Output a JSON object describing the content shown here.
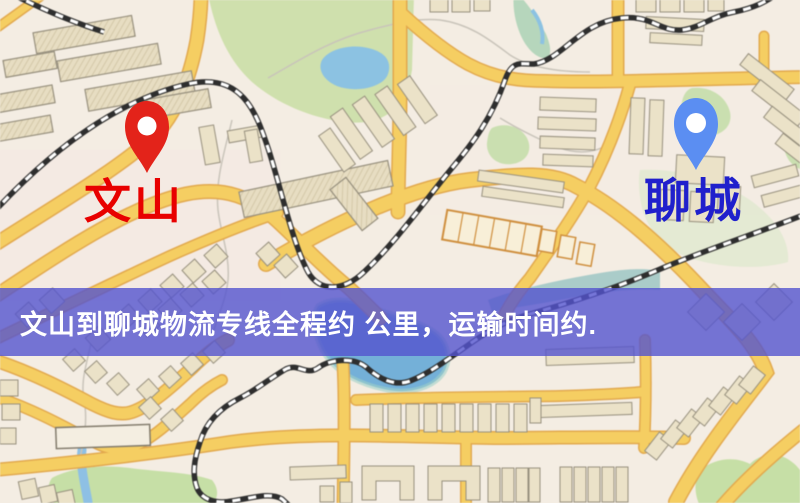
{
  "banner": {
    "text": "文山到聊城物流专线全程约 公里，运输时间约.",
    "background_color": "#5454ce",
    "text_color": "#ffffff"
  },
  "markers": {
    "origin": {
      "label": "文山",
      "pin_color": "#e3231a",
      "label_color": "#e80000"
    },
    "destination": {
      "label": "聊城",
      "pin_color": "#5b8ef2",
      "label_color": "#2020cc"
    }
  },
  "map_palette": {
    "background": "#f4ede3",
    "road": "#f5ce62",
    "road_casing": "#e2a94e",
    "railway": "#2e2e2e",
    "water": "#8cc2e2",
    "park": "#cfe0ad",
    "building": "#ebe2c8"
  }
}
